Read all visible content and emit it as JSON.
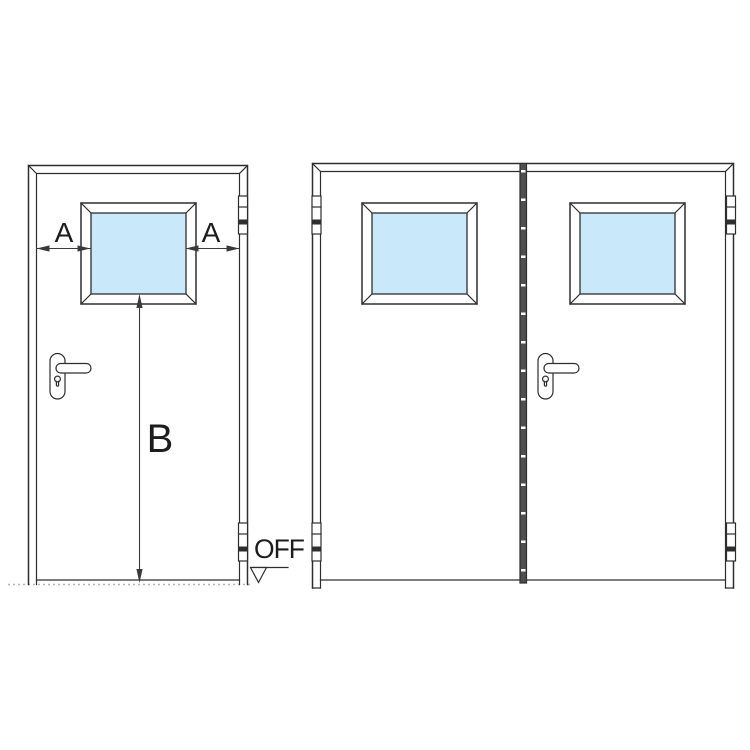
{
  "diagram": {
    "labels": {
      "dim_a_left": "A",
      "dim_a_right": "A",
      "dim_b": "B",
      "floor_level": "OFF"
    },
    "colors": {
      "background": "#ffffff",
      "line": "#2e2e2e",
      "dim": "#3a3a3a",
      "glass": "#c9e8f9",
      "ground": "#b5b5b5",
      "stile": "#4f4f4f",
      "white": "#ffffff"
    },
    "views": [
      {
        "id": "single-leaf-door"
      },
      {
        "id": "double-leaf-door"
      }
    ]
  }
}
